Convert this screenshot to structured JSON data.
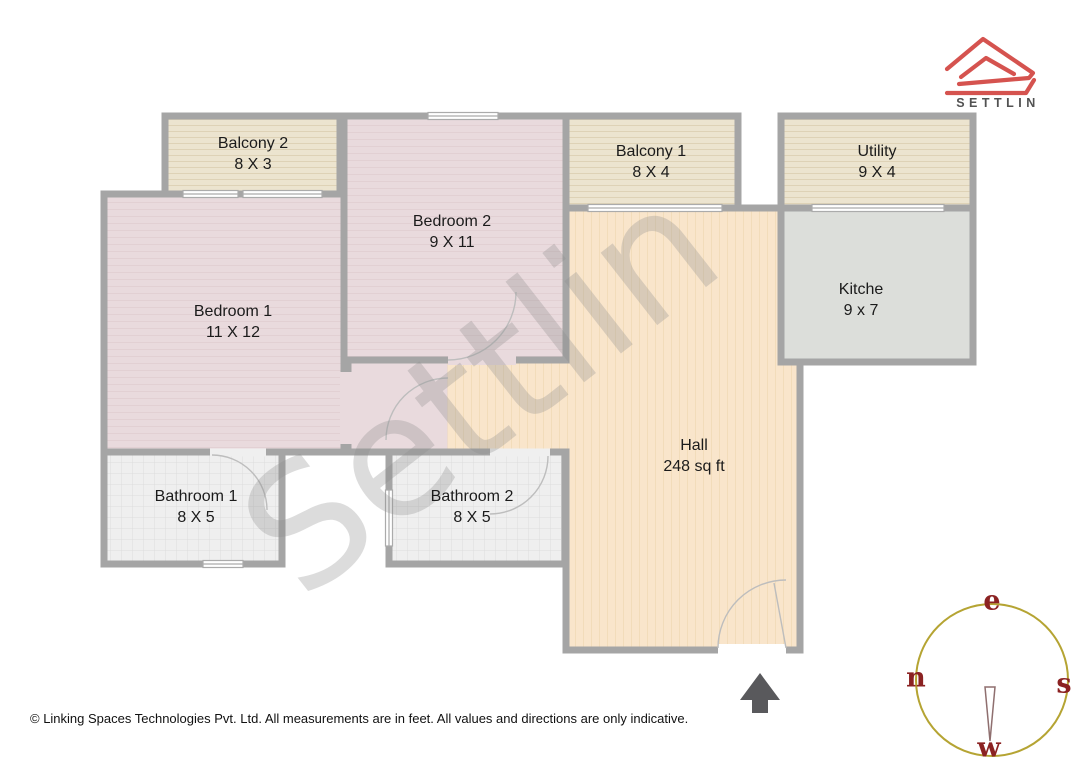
{
  "brand": {
    "name": "SETTLIN"
  },
  "watermark": "Settlin",
  "rooms": [
    {
      "name": "Balcony 2",
      "dims": "8 X 3"
    },
    {
      "name": "Bedroom 2",
      "dims": "9 X 11"
    },
    {
      "name": "Balcony 1",
      "dims": "8 X 4"
    },
    {
      "name": "Utility",
      "dims": "9 X 4"
    },
    {
      "name": "Bedroom 1",
      "dims": "11 X 12"
    },
    {
      "name": "Kitche",
      "dims": "9 x 7"
    },
    {
      "name": "Hall",
      "dims": "248 sq ft"
    },
    {
      "name": "Bathroom 1",
      "dims": "8 X 5"
    },
    {
      "name": "Bathroom 2",
      "dims": "8 X 5"
    }
  ],
  "compass": {
    "top": "e",
    "left": "n",
    "right": "s",
    "bottom": "w"
  },
  "footer": "© Linking Spaces Technologies Pvt. Ltd. All measurements are in feet. All values and directions are only indicative.",
  "colors": {
    "wall_gray": "#a5a5a5",
    "balcony_floor": "#ece4cf",
    "bedroom_floor": "#e9dadd",
    "hall_floor": "#f9e5cb",
    "kitchen_floor": "#dcdeda",
    "bathroom_floor": "#efefef",
    "logo_red": "#d5534f",
    "compass_ring_gold": "#b5a433",
    "compass_letter_red": "#8b2222",
    "entrance_arrow_gray": "#59595c"
  }
}
